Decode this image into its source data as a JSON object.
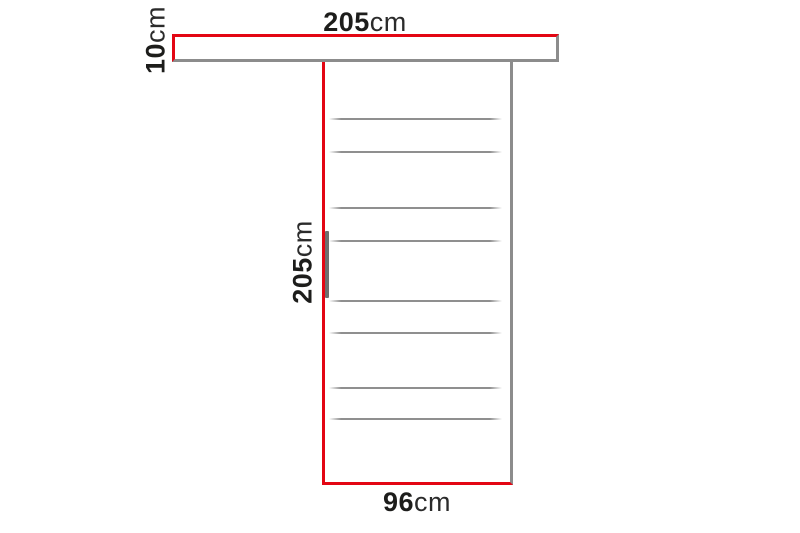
{
  "diagram": {
    "dimensions": {
      "rail_width": {
        "value": "205",
        "unit": "cm"
      },
      "rail_height": {
        "value": "10",
        "unit": "cm"
      },
      "door_height": {
        "value": "205",
        "unit": "cm"
      },
      "door_width": {
        "value": "96",
        "unit": "cm"
      }
    },
    "colors": {
      "dimension_red": "#e30613",
      "outline_gray": "#8c8c8c",
      "panel_line_gray": "#8f8f8f",
      "handle_gray": "#6e6e6e",
      "text_color": "#1d1d1b"
    },
    "panel_line_count": 8
  }
}
